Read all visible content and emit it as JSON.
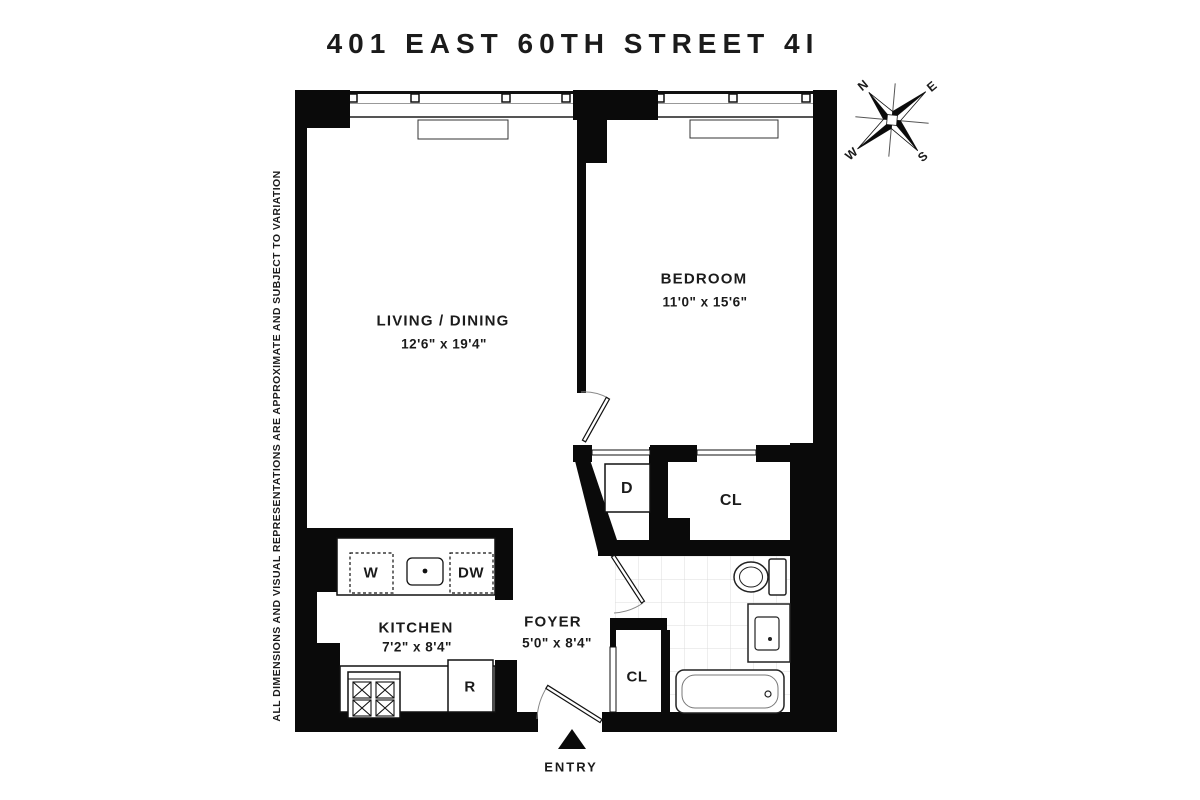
{
  "title": "401 EAST 60TH STREET 4I",
  "disclaimer": "ALL DIMENSIONS AND VISUAL REPRESENTATIONS ARE APPROXIMATE AND SUBJECT TO VARIATION",
  "compass": {
    "n": "N",
    "e": "E",
    "s": "S",
    "w": "W"
  },
  "rooms": {
    "living": {
      "name": "LIVING / DINING",
      "dims": "12'6\" x 19'4\""
    },
    "bedroom": {
      "name": "BEDROOM",
      "dims": "11'0\" x 15'6\""
    },
    "kitchen": {
      "name": "KITCHEN",
      "dims": "7'2\" x 8'4\""
    },
    "foyer": {
      "name": "FOYER",
      "dims": "5'0\" x 8'4\""
    }
  },
  "labels": {
    "washer": "W",
    "dishwasher": "DW",
    "refrigerator": "R",
    "dryer": "D",
    "closet_bedroom": "CL",
    "closet_foyer": "CL",
    "entry": "ENTRY"
  },
  "colors": {
    "wall": "#0a0a0a",
    "tile_line": "#dcdcdc",
    "text": "#1b1b1b"
  }
}
